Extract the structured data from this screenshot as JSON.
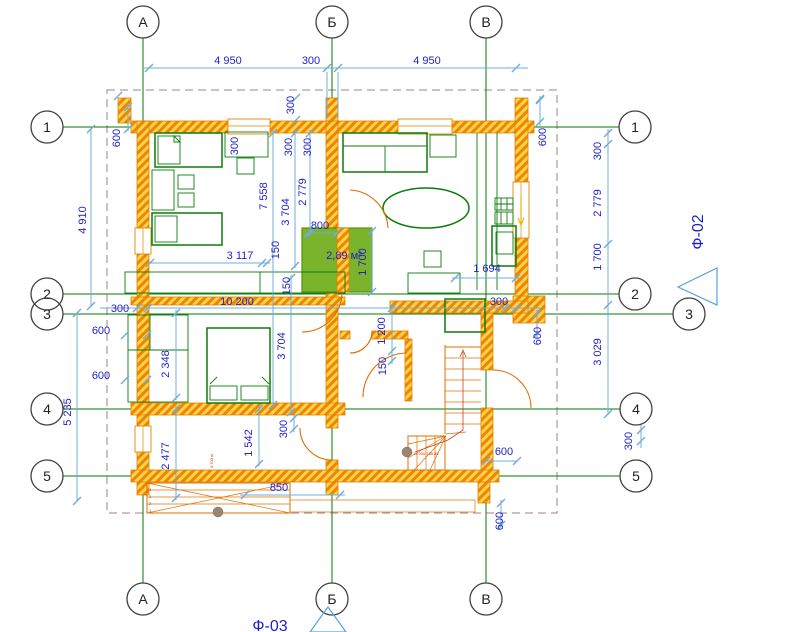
{
  "grid": {
    "columns": [
      "А",
      "Б",
      "В"
    ],
    "rows": [
      "1",
      "2",
      "3",
      "4",
      "5"
    ]
  },
  "markers": {
    "f02": "Ф-02",
    "f03": "Ф-03"
  },
  "labels": {
    "area": "2,89 м²",
    "stair_note": "14 000 185 85",
    "ramp_note": "0,700 м",
    "porch_steps": [
      "4",
      "3",
      "2",
      "1"
    ]
  },
  "dims": {
    "top_left": "4 950",
    "top_mid": "300",
    "top_right": "4 950",
    "l600a": "600",
    "l4910": "4 910",
    "l300": "300",
    "l600b": "600",
    "l600c": "600",
    "l5235": "5 235",
    "r300a": "300",
    "r2779": "2 779",
    "r1700": "1 700",
    "r3029": "3 029",
    "r300b": "300",
    "r600a": "600",
    "r600b": "600",
    "r600c": "600",
    "r600d": "600",
    "t300a": "300",
    "t300b": "300",
    "t300c": "300",
    "t300d": "300",
    "i7558": "7 558",
    "i3704a": "3 704",
    "i2779": "2 779",
    "i3117": "3 117",
    "i150a": "150",
    "i150b": "150",
    "i800": "800",
    "i1700": "1 700",
    "i1694": "1 694",
    "i10200": "10 200",
    "i300r": "300",
    "i1200": "1 200",
    "i150c": "150",
    "i2348": "2 348",
    "i3704b": "3 704",
    "i2477": "2 477",
    "i1542": "1 542",
    "i300d": "300",
    "i850": "850"
  }
}
